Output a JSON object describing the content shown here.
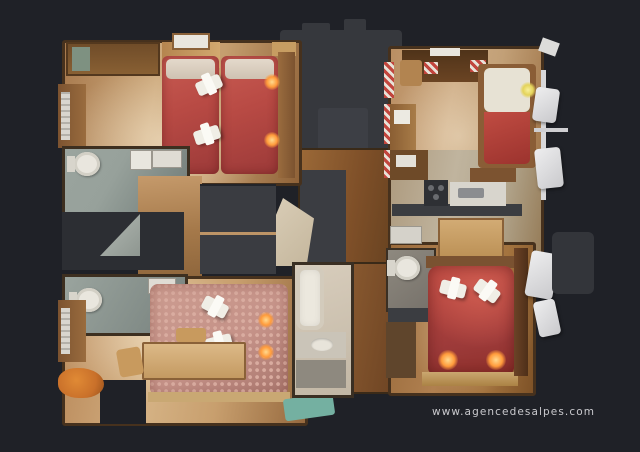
{
  "watermark": {
    "text": "www.agencedesalpes.com"
  },
  "palette": {
    "bg": "#1f2127",
    "wall": "#46311d",
    "wood_light": "#cda97c",
    "wood_dark": "#8f6238",
    "hall_wood": "#7e4f28",
    "bed_red": "#b84a44",
    "bed_red_deep": "#9c3a39",
    "bed_rose": "#c59288",
    "bath_floor": "#97a19b",
    "dark_zone": "#36383d",
    "stair_beige": "#ddd1bb",
    "towel": "#f0eee6",
    "glow": "#ff9b3b",
    "counter_dark": "#3b3d41",
    "fixture_white": "#e9e6de",
    "teal_rug": "#74b0a1",
    "orange_item": "#c9702a",
    "stripe_red": "#c2453d",
    "watermark": "#c9c9cd"
  },
  "scene": {
    "view": "3d-dollhouse-top-down-floor-plan",
    "rooms": [
      {
        "name": "bedroom-top-left",
        "furniture": [
          "twin-bed-red",
          "twin-bed-red",
          "wardrobe",
          "shelf",
          "dresser",
          "radiator",
          "folded-towel",
          "folded-towel",
          "bedside-lamp",
          "bedside-lamp"
        ]
      },
      {
        "name": "bathroom-upper-left",
        "furniture": [
          "toilet",
          "washbasin",
          "washing-machine"
        ]
      },
      {
        "name": "shower-room-lower-left",
        "furniture": [
          "toilet",
          "washbasin",
          "shower",
          "radiator"
        ]
      },
      {
        "name": "bedroom-bottom-left",
        "furniture": [
          "double-bed-rose",
          "folded-towel",
          "folded-towel",
          "table",
          "chair",
          "chair",
          "teal-rug",
          "bedside-lamp",
          "bedside-lamp"
        ]
      },
      {
        "name": "hallway-center",
        "furniture": [
          "staircase",
          "closet",
          "closet"
        ]
      },
      {
        "name": "bathroom-center",
        "furniture": [
          "bathtub",
          "washbasin"
        ]
      },
      {
        "name": "living-room-top-right",
        "furniture": [
          "sofa-bed-red",
          "desk",
          "chair",
          "sideboard",
          "side-table"
        ]
      },
      {
        "name": "kitchen-right",
        "furniture": [
          "counter",
          "stove",
          "sink",
          "dining-table",
          "cabinet"
        ]
      },
      {
        "name": "bathroom-right",
        "furniture": [
          "toilet",
          "washbasin-counter"
        ]
      },
      {
        "name": "bedroom-bottom-right",
        "furniture": [
          "double-bed-red",
          "folded-towel",
          "folded-towel",
          "bedside-lamp",
          "bedside-lamp",
          "closet"
        ]
      },
      {
        "name": "balcony-right",
        "furniture": [
          "chair-white",
          "chair-white",
          "chair-white",
          "chair-white",
          "railing"
        ]
      }
    ]
  }
}
